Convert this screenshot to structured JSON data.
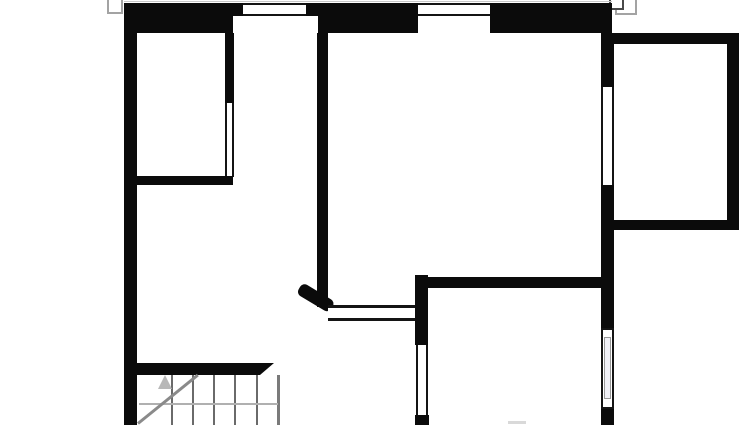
{
  "canvas": {
    "width": 750,
    "height": 425,
    "background": "#ffffff"
  },
  "colors": {
    "wall": "#0b0b0b",
    "window_line": "#141414",
    "window_fill": "#ffffff",
    "framed_window_fill": "#f0f0f6",
    "roof_outline_gray": "#a3a3a3",
    "roof_outline_dark": "#4a4a4a",
    "stair_tread": "#6a6a6a",
    "stair_landing": "#b0b0b0",
    "stair_diagonal": "#8a8a8a",
    "stair_arrow": "#b8b8b8",
    "edge_line": "#c8c8c8",
    "smudge": "#d9d9d9"
  },
  "elements": [
    {
      "name": "roof-outline-left",
      "style": "left:107px;top:-4px;width:16px;height:18px;background:#ffffff;border:2px solid #a3a3a3"
    },
    {
      "name": "roof-outline-right-outer",
      "style": "left:615px;top:-4px;width:22px;height:19px;background:#ffffff;border:2px solid #a3a3a3"
    },
    {
      "name": "roof-outline-right-inner",
      "style": "left:609px;top:-4px;width:15px;height:14px;background:#ffffff;border:2px solid #4a4a4a"
    },
    {
      "name": "top-edge-line",
      "style": "left:124px;top:1px;width:488px;height:1px;background:#c8c8c8"
    },
    {
      "name": "exterior-wall-left",
      "style": "left:124px;top:3px;width:13px;height:422px;background:#0b0b0b"
    },
    {
      "name": "exterior-wall-top-left",
      "style": "left:124px;top:3px;width:109px;height:30px;background:#0b0b0b"
    },
    {
      "name": "exterior-wall-top-thin-a",
      "style": "left:233px;top:3px;width:10px;height:13px;background:#0b0b0b"
    },
    {
      "name": "window-top-left",
      "style": "left:243px;top:3px;width:63px;height:13px;background:#ffffff;border-top:2px solid #141414;border-bottom:2px solid #141414"
    },
    {
      "name": "exterior-wall-top-thin-b",
      "style": "left:306px;top:3px;width:12px;height:13px;background:#0b0b0b"
    },
    {
      "name": "exterior-wall-top-center",
      "style": "left:318px;top:3px;width:100px;height:30px;background:#0b0b0b"
    },
    {
      "name": "window-top-right",
      "style": "left:418px;top:3px;width:72px;height:13px;background:#ffffff;border-top:2px solid #141414;border-bottom:2px solid #141414"
    },
    {
      "name": "exterior-wall-top-right",
      "style": "left:490px;top:3px;width:122px;height:30px;background:#0b0b0b"
    },
    {
      "name": "exterior-wall-right-upper",
      "style": "left:601px;top:33px;width:13px;height:54px;background:#0b0b0b"
    },
    {
      "name": "window-right-upper",
      "style": "left:601px;top:87px;width:13px;height:98px;background:#ffffff;border-left:2px solid #141414;border-right:2px solid #141414"
    },
    {
      "name": "exterior-wall-right-mid",
      "style": "left:601px;top:185px;width:13px;height:143px;background:#0b0b0b"
    },
    {
      "name": "window-right-framed-outer",
      "style": "left:601px;top:328px;width:13px;height:81px;background:#ffffff;border:2px solid #141414"
    },
    {
      "name": "window-right-framed-inner",
      "style": "left:604px;top:337px;width:7px;height:62px;background:#f0f0f6;border:1px solid #999999"
    },
    {
      "name": "exterior-wall-right-lower",
      "style": "left:601px;top:409px;width:13px;height:16px;background:#0b0b0b"
    },
    {
      "name": "annex-wall-top",
      "style": "left:604px;top:33px;width:135px;height:11px;background:#0b0b0b"
    },
    {
      "name": "annex-wall-right",
      "style": "left:727px;top:33px;width:12px;height:197px;background:#0b0b0b"
    },
    {
      "name": "annex-wall-bottom",
      "style": "left:613px;top:220px;width:126px;height:10px;background:#0b0b0b"
    },
    {
      "name": "closet-wall-vertical",
      "style": "left:225px;top:33px;width:9px;height:70px;background:#0b0b0b"
    },
    {
      "name": "closet-glass-partition",
      "style": "left:225px;top:103px;width:9px;height:74px;background:#ffffff;border-left:2px solid #141414;border-right:2px solid #141414"
    },
    {
      "name": "closet-wall-horizontal",
      "style": "left:137px;top:176px;width:96px;height:9px;background:#0b0b0b"
    },
    {
      "name": "center-partition-wall",
      "style": "left:317px;top:33px;width:11px;height:274px;background:#0b0b0b"
    },
    {
      "name": "door-jamb-diagonal",
      "style": "left:294px;top:301px;width:38px;height:13px;background:#0b0b0b;border-radius:5px;transform:rotate(31deg);transform-origin:100% 50%"
    },
    {
      "name": "hall-glass-partition",
      "style": "left:328px;top:305px;width:87px;height:16px;background:#ffffff;border-top:3px solid #141414;border-bottom:3px solid #141414"
    },
    {
      "name": "mid-wall-vertical",
      "style": "left:415px;top:275px;width:13px;height:70px;background:#0b0b0b"
    },
    {
      "name": "window-mid-lower",
      "style": "left:416px;top:345px;width:12px;height:70px;background:#ffffff;border-left:2px solid #141414;border-right:2px solid #141414"
    },
    {
      "name": "mid-wall-sill-block",
      "style": "left:415px;top:415px;width:14px;height:10px;background:#0b0b0b"
    },
    {
      "name": "interior-wall-horizontal",
      "style": "left:415px;top:277px;width:199px;height:11px;background:#0b0b0b"
    },
    {
      "name": "stair-wall",
      "style": "left:137px;top:363px;width:123px;height:12px;background:#0b0b0b"
    },
    {
      "name": "stair-wall-tip",
      "style": "left:260px;top:363px;width:14px;height:12px;background:#0b0b0b;clip-path:polygon(0 0,100% 0,0 100%)"
    },
    {
      "name": "stair-tread-1",
      "style": "left:171px;top:375px;width:2px;height:50px;background:#6a6a6a"
    },
    {
      "name": "stair-tread-2",
      "style": "left:192px;top:375px;width:2px;height:50px;background:#6a6a6a"
    },
    {
      "name": "stair-tread-3",
      "style": "left:213px;top:375px;width:2px;height:50px;background:#6a6a6a"
    },
    {
      "name": "stair-tread-4",
      "style": "left:234px;top:375px;width:2px;height:50px;background:#6a6a6a"
    },
    {
      "name": "stair-tread-5",
      "style": "left:256px;top:375px;width:2px;height:50px;background:#6a6a6a"
    },
    {
      "name": "stair-right-edge-line",
      "style": "left:277px;top:375px;width:3px;height:50px;background:#7a7a7a"
    },
    {
      "name": "stair-landing-line",
      "style": "left:139px;top:403px;width:139px;height:2px;background:#b0b0b0"
    },
    {
      "name": "stair-direction-diagonal",
      "style": "left:138px;top:422px;width:77px;height:3px;background:#8a8a8a;transform:rotate(-39deg);transform-origin:0 50%"
    },
    {
      "name": "stair-up-arrow",
      "style": "left:158px;top:375px;width:0;height:0;border-left:7px solid transparent;border-right:7px solid transparent;border-bottom:14px solid #b8b8b8"
    },
    {
      "name": "bottom-edge-smudge",
      "style": "left:508px;top:421px;width:18px;height:3px;background:#d9d9d9"
    }
  ]
}
